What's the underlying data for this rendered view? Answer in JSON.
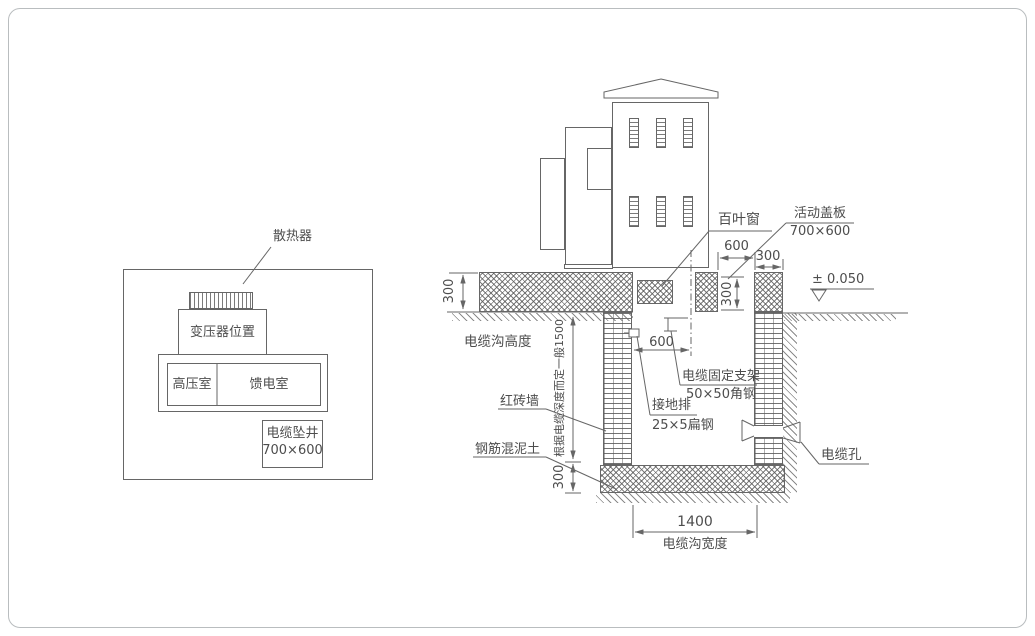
{
  "plan": {
    "radiator_label": "散热器",
    "transformer_room": "变压器位置",
    "hv_room": "高压室",
    "feeder_room": "馈电室",
    "cable_shaft_label": "电缆坠井",
    "cable_shaft_size": "700×600"
  },
  "section": {
    "louver_label": "百叶窗",
    "cover_label": "活动盖板",
    "cover_size": "700×600",
    "level_mark": "± 0.050",
    "trench_height_label": "电缆沟高度",
    "depth_note": "根据电缆深度而定一般1500",
    "brick_wall_label": "红砖墙",
    "concrete_label": "钢筋混泥土",
    "bracket_label": "电缆固定支架",
    "bracket_spec": "50×50角钢",
    "ground_bar_label": "接地排",
    "ground_bar_spec": "25×5扁钢",
    "cable_hole_label": "电缆孔",
    "trench_width_label": "电缆沟宽度",
    "dims": {
      "opening_width": "600",
      "cap_width": "300",
      "cover_depth": "300",
      "slab_thickness": "300",
      "inner_width": "600",
      "floor_thickness": "300",
      "trench_width": "1400"
    }
  },
  "colors": {
    "line": "#666666",
    "text": "#4d4d4d",
    "border": "#b9bdbf"
  }
}
